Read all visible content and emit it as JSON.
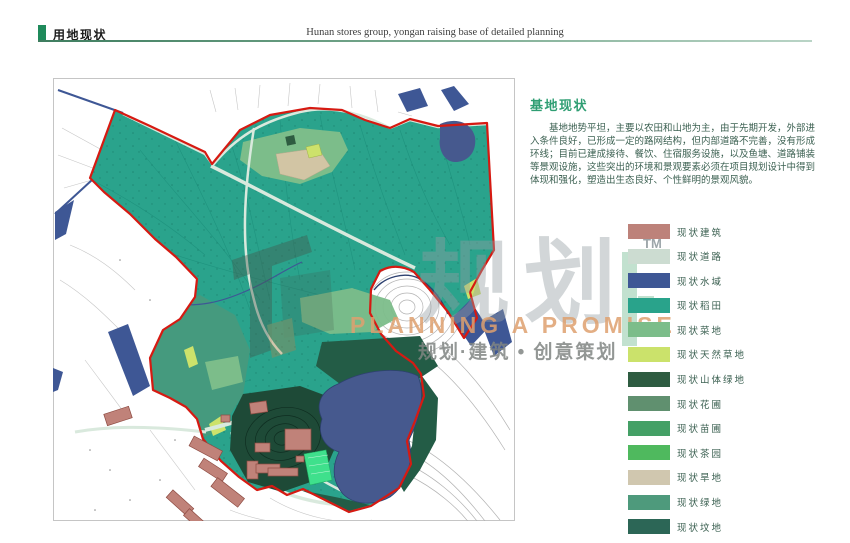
{
  "header": {
    "title_cn": "用地现状",
    "title_en": "Hunan stores group, yongan raising base of detailed planning",
    "accent_color": "#1f8a5b"
  },
  "description": {
    "heading": "基地现状",
    "heading_color": "#2f9e73",
    "body": "基地地势平坦，主要以农田和山地为主，由于先期开发，外部进入条件良好，已形成一定的路网结构，但内部道路不完善，没有形成环线；目前已建成接待、餐饮、住宿服务设施，以及鱼塘、道路铺装等景观设施，这些突出的环境和景观要素必须在项目规划设计中得到体现和强化，塑造出生态良好、个性鲜明的景观风貌。"
  },
  "legend": {
    "items": [
      {
        "label": "现状建筑",
        "color": "#bd827a"
      },
      {
        "label": "现状道路",
        "color": "#ccdcd1"
      },
      {
        "label": "现状水域",
        "color": "#3e5795"
      },
      {
        "label": "现状稻田",
        "color": "#29a38b"
      },
      {
        "label": "现状菜地",
        "color": "#7cbd8a"
      },
      {
        "label": "现状天然草地",
        "color": "#cbe26b"
      },
      {
        "label": "现状山体绿地",
        "color": "#2e5c41"
      },
      {
        "label": "现状花圃",
        "color": "#60906f"
      },
      {
        "label": "现状苗圃",
        "color": "#44a066"
      },
      {
        "label": "现状茶园",
        "color": "#4fb95e"
      },
      {
        "label": "现状旱地",
        "color": "#d0c7af"
      },
      {
        "label": "现状绿地",
        "color": "#4e9a7c"
      },
      {
        "label": "现状坟地",
        "color": "#2c6656"
      }
    ]
  },
  "watermark": {
    "tm": "TM",
    "big_text": "规划",
    "english": "PLANNING A PROMISE",
    "tagline": "规划·建筑 • 创意策划"
  },
  "map": {
    "boundary_color": "#d61a12",
    "features": [
      "规划红线边界",
      "现状稻田",
      "鱼塘水域",
      "山体绿地",
      "现状建筑群",
      "等高线山体",
      "现状道路"
    ]
  }
}
